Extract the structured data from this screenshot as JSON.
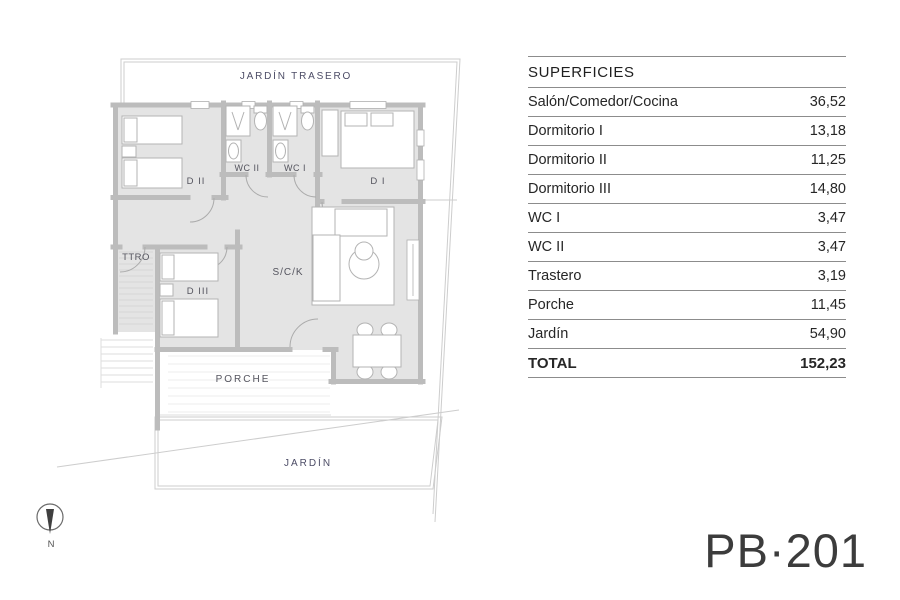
{
  "plan": {
    "labels": {
      "back_garden": "JARDÍN TRASERO",
      "bedroom_2": "D II",
      "wc_2": "WC II",
      "wc_1": "WC I",
      "bedroom_1": "D I",
      "storage": "TTRO",
      "bedroom_3": "D III",
      "living_kitchen": "S/C/K",
      "porch": "PORCHE",
      "garden": "JARDÍN"
    },
    "compass_label": "N",
    "colors": {
      "wall_gray": "#bcbcbc",
      "floor_gray": "#e4e4e4",
      "boundary_gray": "#cdcdcd",
      "garden_label_navy": "#4c4c66",
      "room_label_slate": "#54545e",
      "table_line_gray": "#8c8c8c",
      "code_gray": "#3c3c3c"
    }
  },
  "areas_table": {
    "header": "SUPERFICIES",
    "rows": [
      {
        "label": "Salón/Comedor/Cocina",
        "value": "36,52"
      },
      {
        "label": "Dormitorio I",
        "value": "13,18"
      },
      {
        "label": "Dormitorio II",
        "value": "11,25"
      },
      {
        "label": "Dormitorio III",
        "value": "14,80"
      },
      {
        "label": "WC I",
        "value": "3,47"
      },
      {
        "label": "WC II",
        "value": "3,47"
      },
      {
        "label": "Trastero",
        "value": "3,19"
      },
      {
        "label": "Porche",
        "value": "11,45"
      },
      {
        "label": "Jardín",
        "value": "54,90"
      }
    ],
    "total": {
      "label": "TOTAL",
      "value": "152,23"
    }
  },
  "plan_code": "PB·201"
}
